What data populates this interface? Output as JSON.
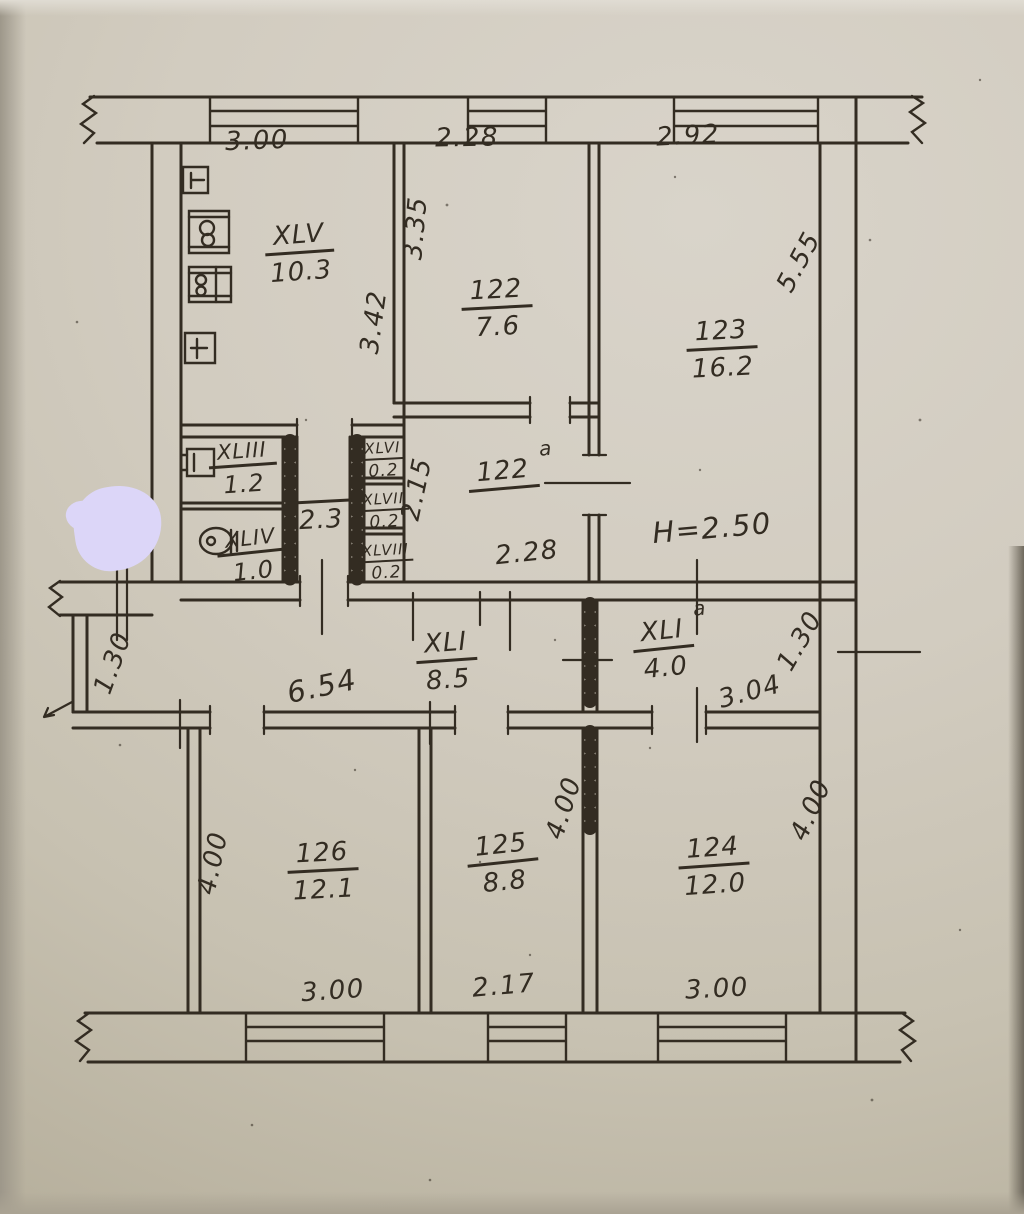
{
  "document": {
    "kind": "hand-drawn apartment floor plan (scanned photo)",
    "ceiling_height": "H=2.50"
  },
  "rooms": {
    "xlv": {
      "num": "XLV",
      "area": "10.3"
    },
    "r122": {
      "num": "122",
      "area": "7.6"
    },
    "r123": {
      "num": "123",
      "area": "16.2"
    },
    "r122a": {
      "num": "122",
      "sup": "a"
    },
    "xliii": {
      "num": "XLIII",
      "area": "1.2"
    },
    "xliv": {
      "num": "XLIV",
      "area": "1.0"
    },
    "hall": {
      "area": "2.3"
    },
    "xlvi": {
      "num": "XLVI",
      "area": "0.2"
    },
    "xlvii": {
      "num": "XLVII",
      "area": "0.2"
    },
    "xlviii": {
      "num": "XLVIII",
      "area": "0.2"
    },
    "xli": {
      "num": "XLI",
      "area": "8.5"
    },
    "xlia": {
      "num": "XLI",
      "sup": "a",
      "area": "4.0"
    },
    "r126": {
      "num": "126",
      "area": "12.1"
    },
    "r125": {
      "num": "125",
      "area": "8.8"
    },
    "r124": {
      "num": "124",
      "area": "12.0"
    }
  },
  "dims": {
    "top1": "3.00",
    "top2": "2.28",
    "top3": "2.92",
    "v335": "3.35",
    "v342": "3.42",
    "v555": "5.55",
    "v215": "2.15",
    "w228": "2.28",
    "ceiling": "H=2.50",
    "d654": "6.54",
    "d304": "3.04",
    "left130": "1.30",
    "right130": "1.30",
    "h400_left": "4.00",
    "h400_mid": "4.00",
    "h400_right": "4.00",
    "bot1": "3.00",
    "bot2": "2.17",
    "bot3": "3.00"
  },
  "colors": {
    "ink": "#332c22",
    "paper": "#cfc9bc",
    "blob": "#dcd6f8"
  }
}
